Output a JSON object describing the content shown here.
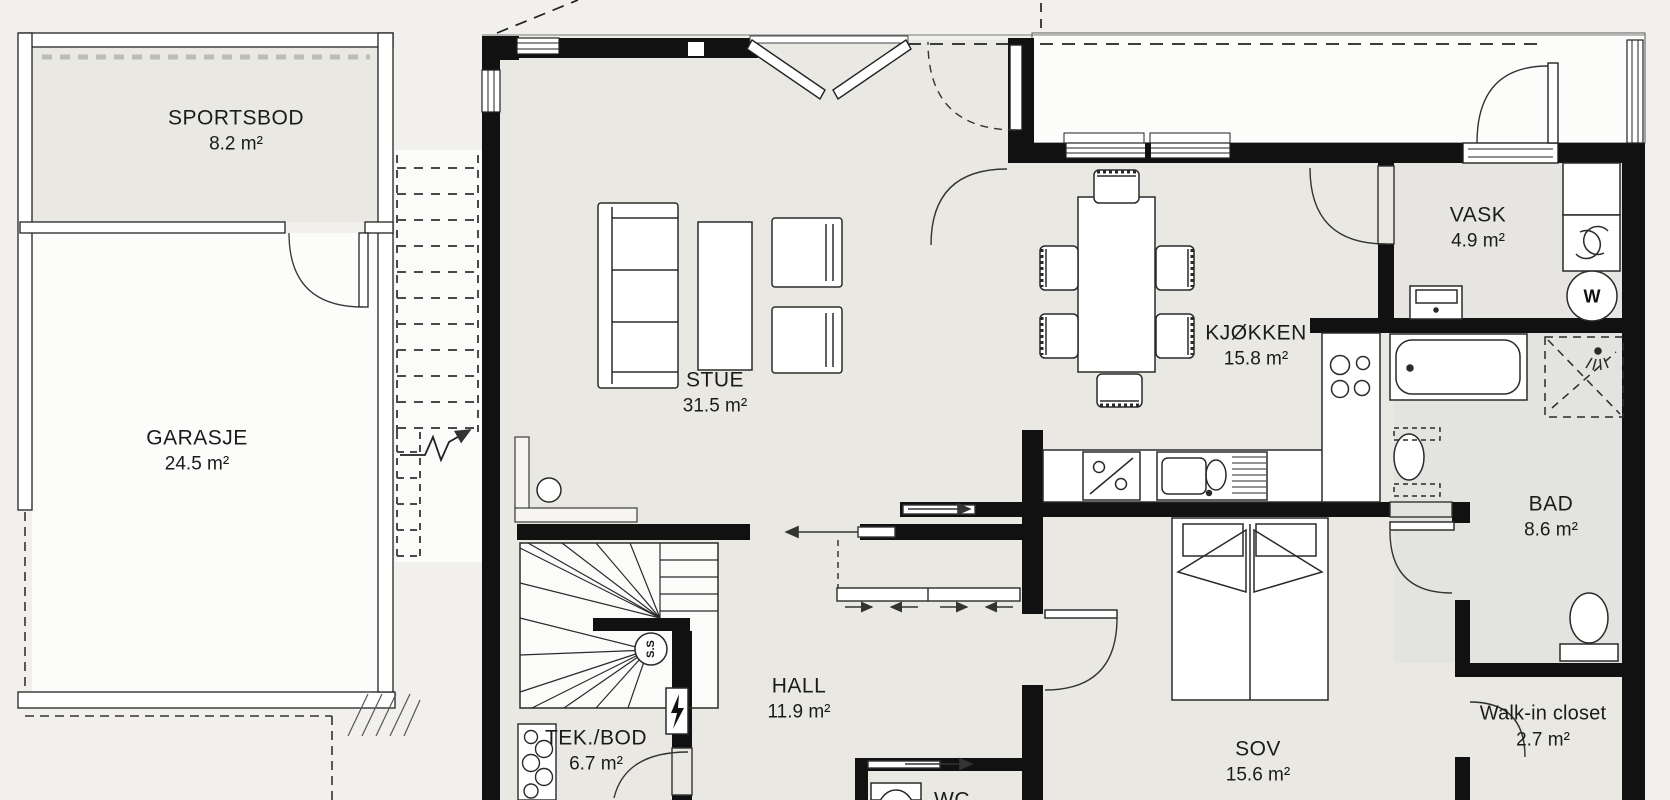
{
  "title": "Floor plan",
  "rooms": {
    "sportsbod": {
      "name": "SPORTSBOD",
      "area": "8.2 m²"
    },
    "garasje": {
      "name": "GARASJE",
      "area": "24.5 m²"
    },
    "stue": {
      "name": "STUE",
      "area": "31.5 m²"
    },
    "kjokken": {
      "name": "KJØKKEN",
      "area": "15.8 m²"
    },
    "vask": {
      "name": "VASK",
      "area": "4.9 m²"
    },
    "bad": {
      "name": "BAD",
      "area": "8.6 m²"
    },
    "hall": {
      "name": "HALL",
      "area": "11.9 m²"
    },
    "tekbod": {
      "name": "TEK./BOD",
      "area": "6.7 m²"
    },
    "sov": {
      "name": "SOV",
      "area": "15.6 m²"
    },
    "walkin": {
      "name": "Walk-in closet",
      "area": "2.7 m²"
    },
    "wc": {
      "name": "WC"
    }
  },
  "symbols": {
    "washer": "W",
    "stair_marker": "S.S"
  },
  "colors": {
    "wall": "#111111",
    "room_fill": "#e9e8e3",
    "wet_room_fill": "#e3e3e0",
    "outdoor_fill": "#fcfcfb",
    "background": "#f1f0ec",
    "line": "#2a2a2a"
  }
}
